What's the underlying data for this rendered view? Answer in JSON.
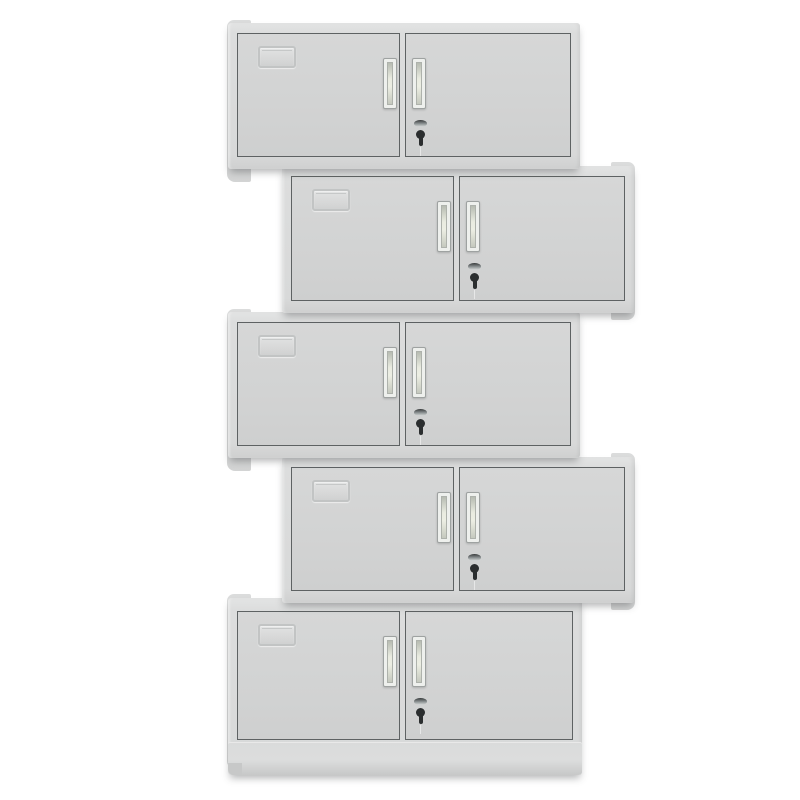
{
  "scene": {
    "description": "Product render: five identical light-grey two-door steel office cabinets stacked vertically in an alternating left/right zig-zag offset on a white background",
    "background_color": "#ffffff",
    "unit_count": 5
  },
  "colors": {
    "bg": "#ffffff",
    "frame": "#dcdddd",
    "side_panel": "#dbdcdc",
    "door_face": "#d1d2d2",
    "door_face_light": "#d6d7d7",
    "door_border": "#5e6263",
    "handle_frame": "#eef0ed",
    "handle_border": "#9ea2a1",
    "slot_light": "#e9ebe0",
    "slot_dark": "#b7bcb2",
    "keyhole": "#2b2e2f",
    "cap_dark": "#36393a",
    "cap_light": "#d9dcdc",
    "label_border": "#c2c4c4",
    "plinth_dark": "#c7c8c8",
    "shadow": "rgba(55,58,60,0.38)"
  },
  "cabinets": [
    {
      "id": "cabinet-1",
      "align": "left",
      "x": 228,
      "y": 23,
      "width": 352,
      "height": 146,
      "has_plinth": false
    },
    {
      "id": "cabinet-2",
      "align": "right",
      "x": 282,
      "y": 166,
      "width": 352,
      "height": 147,
      "has_plinth": false
    },
    {
      "id": "cabinet-3",
      "align": "left",
      "x": 228,
      "y": 312,
      "width": 352,
      "height": 146,
      "has_plinth": false
    },
    {
      "id": "cabinet-4",
      "align": "right",
      "x": 282,
      "y": 457,
      "width": 352,
      "height": 146,
      "has_plinth": false
    },
    {
      "id": "cabinet-5",
      "align": "left",
      "x": 228,
      "y": 598,
      "width": 354,
      "height": 177,
      "has_plinth": true
    }
  ],
  "cabinet_features": {
    "doors_per_unit": 2,
    "handles_per_unit": 2,
    "keyhole_on_right_door": true,
    "label_card_holder_on_left_door": true
  }
}
